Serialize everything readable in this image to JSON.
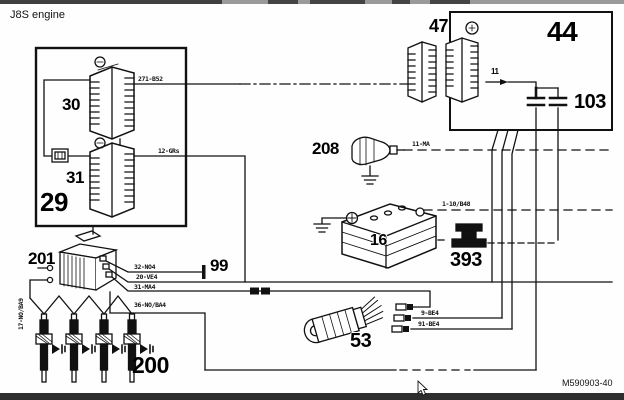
{
  "title": "J8S engine",
  "footer": {
    "drawing_ref": "M590903-40"
  },
  "components": {
    "box29": "29",
    "conn30": "30",
    "conn31": "31",
    "box44": "44",
    "conn47": "47",
    "cap103": "103",
    "sensor208": "208",
    "battery16": "16",
    "link393": "393",
    "relay201": "201",
    "term99": "99",
    "plugs200": "200",
    "starter53": "53",
    "wire11": "11"
  },
  "wire_labels": {
    "w271": "271-B52",
    "w12": "12-GRs",
    "w11ma": "11-MA",
    "w110": "1-10/B48",
    "w32": "32-NO4",
    "w20": "20-VE4",
    "w31": "31-MA4",
    "w36": "36-NO/BA4",
    "w17": "17-NO/BA9",
    "w9": "9-BE4",
    "w91": "91-BE4"
  }
}
